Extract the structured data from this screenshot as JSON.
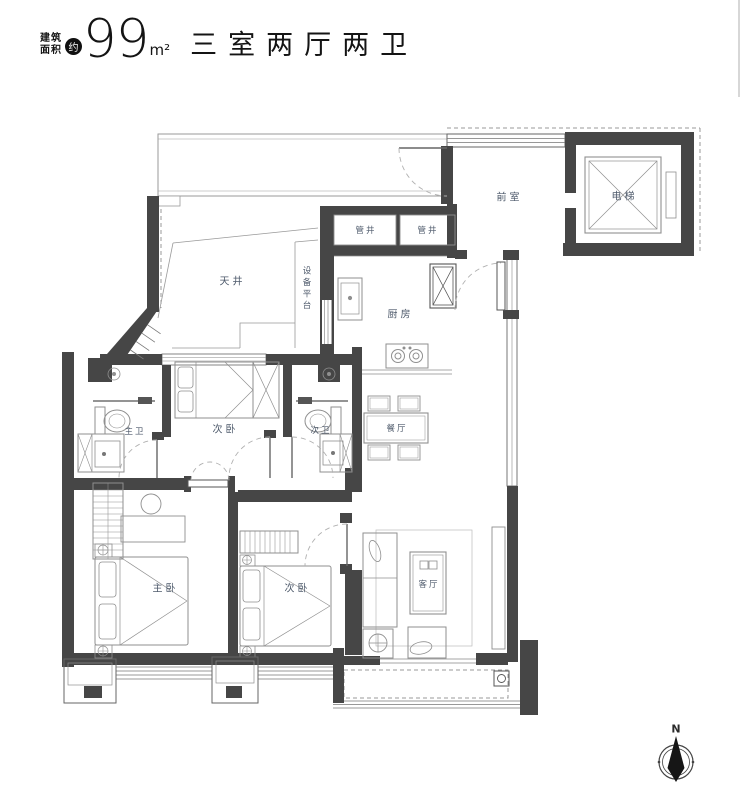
{
  "header": {
    "area_prefix_line1": "建筑",
    "area_prefix_line2": "面积",
    "approx_badge": "约",
    "area_value": "99",
    "area_unit": "m²",
    "title": "三室两厅两卫"
  },
  "rooms": {
    "front_room": "前室",
    "elevator": "电梯",
    "pipe_shaft_left": "管井",
    "pipe_shaft_right": "管井",
    "light_well": "天井",
    "equipment_platform": "设备平台",
    "kitchen": "厨房",
    "second_bedroom_top": "次卧",
    "master_bathroom": "主卫",
    "second_bathroom": "次卫",
    "dining_room": "餐厅",
    "master_bedroom": "主卧",
    "second_bedroom_bottom": "次卧",
    "living_room": "客厅"
  },
  "compass": {
    "north_label": "N"
  },
  "colors": {
    "wall": "#464646",
    "room_label": "#4e5a6b",
    "furniture_line": "#8f8f8f",
    "badge_bg": "#101010"
  }
}
